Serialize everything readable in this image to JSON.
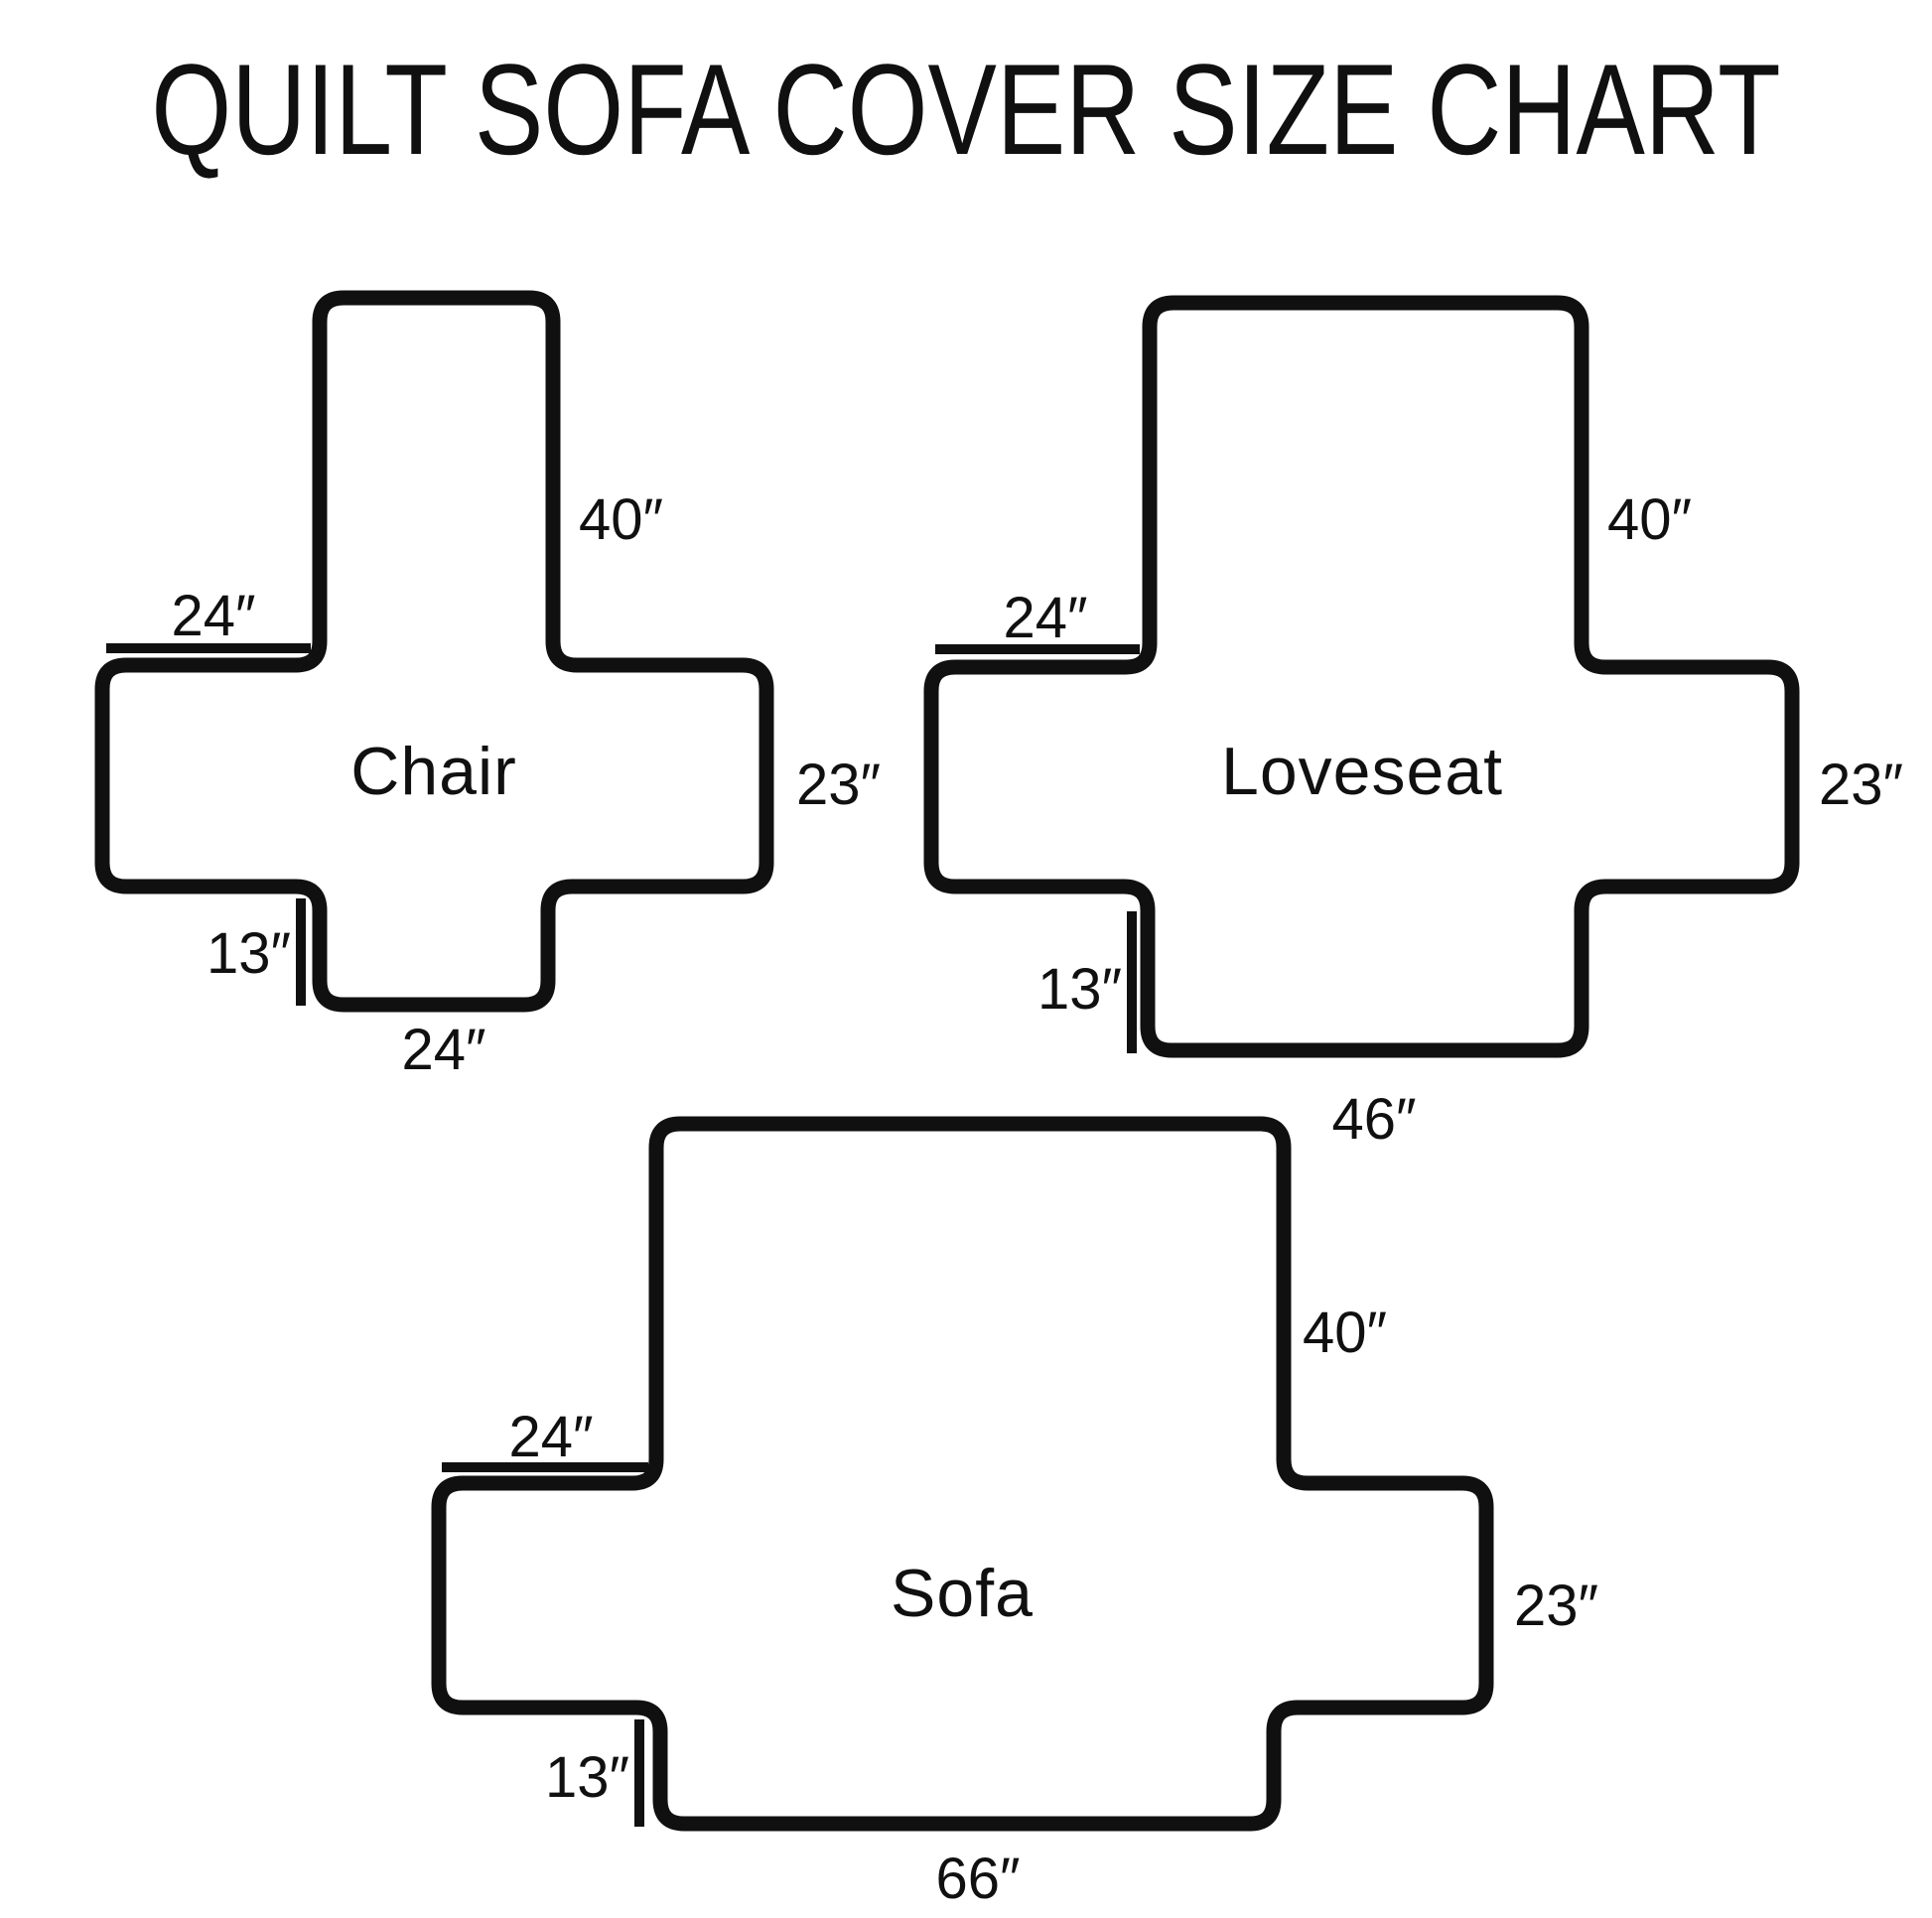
{
  "title": "QUILT SOFA COVER SIZE CHART",
  "colors": {
    "ink": "#101010",
    "background": "#ffffff"
  },
  "diagrams": [
    {
      "label": "Chair",
      "back_height": "40″",
      "arm_top_width": "24″",
      "side_height": "23″",
      "skirt_drop": "13″",
      "front_width": "24″"
    },
    {
      "label": "Loveseat",
      "back_height": "40″",
      "arm_top_width": "24″",
      "side_height": "23″",
      "skirt_drop": "13″",
      "front_width": "46″"
    },
    {
      "label": "Sofa",
      "back_height": "40″",
      "arm_top_width": "24″",
      "side_height": "23″",
      "skirt_drop": "13″",
      "front_width": "66″"
    }
  ]
}
